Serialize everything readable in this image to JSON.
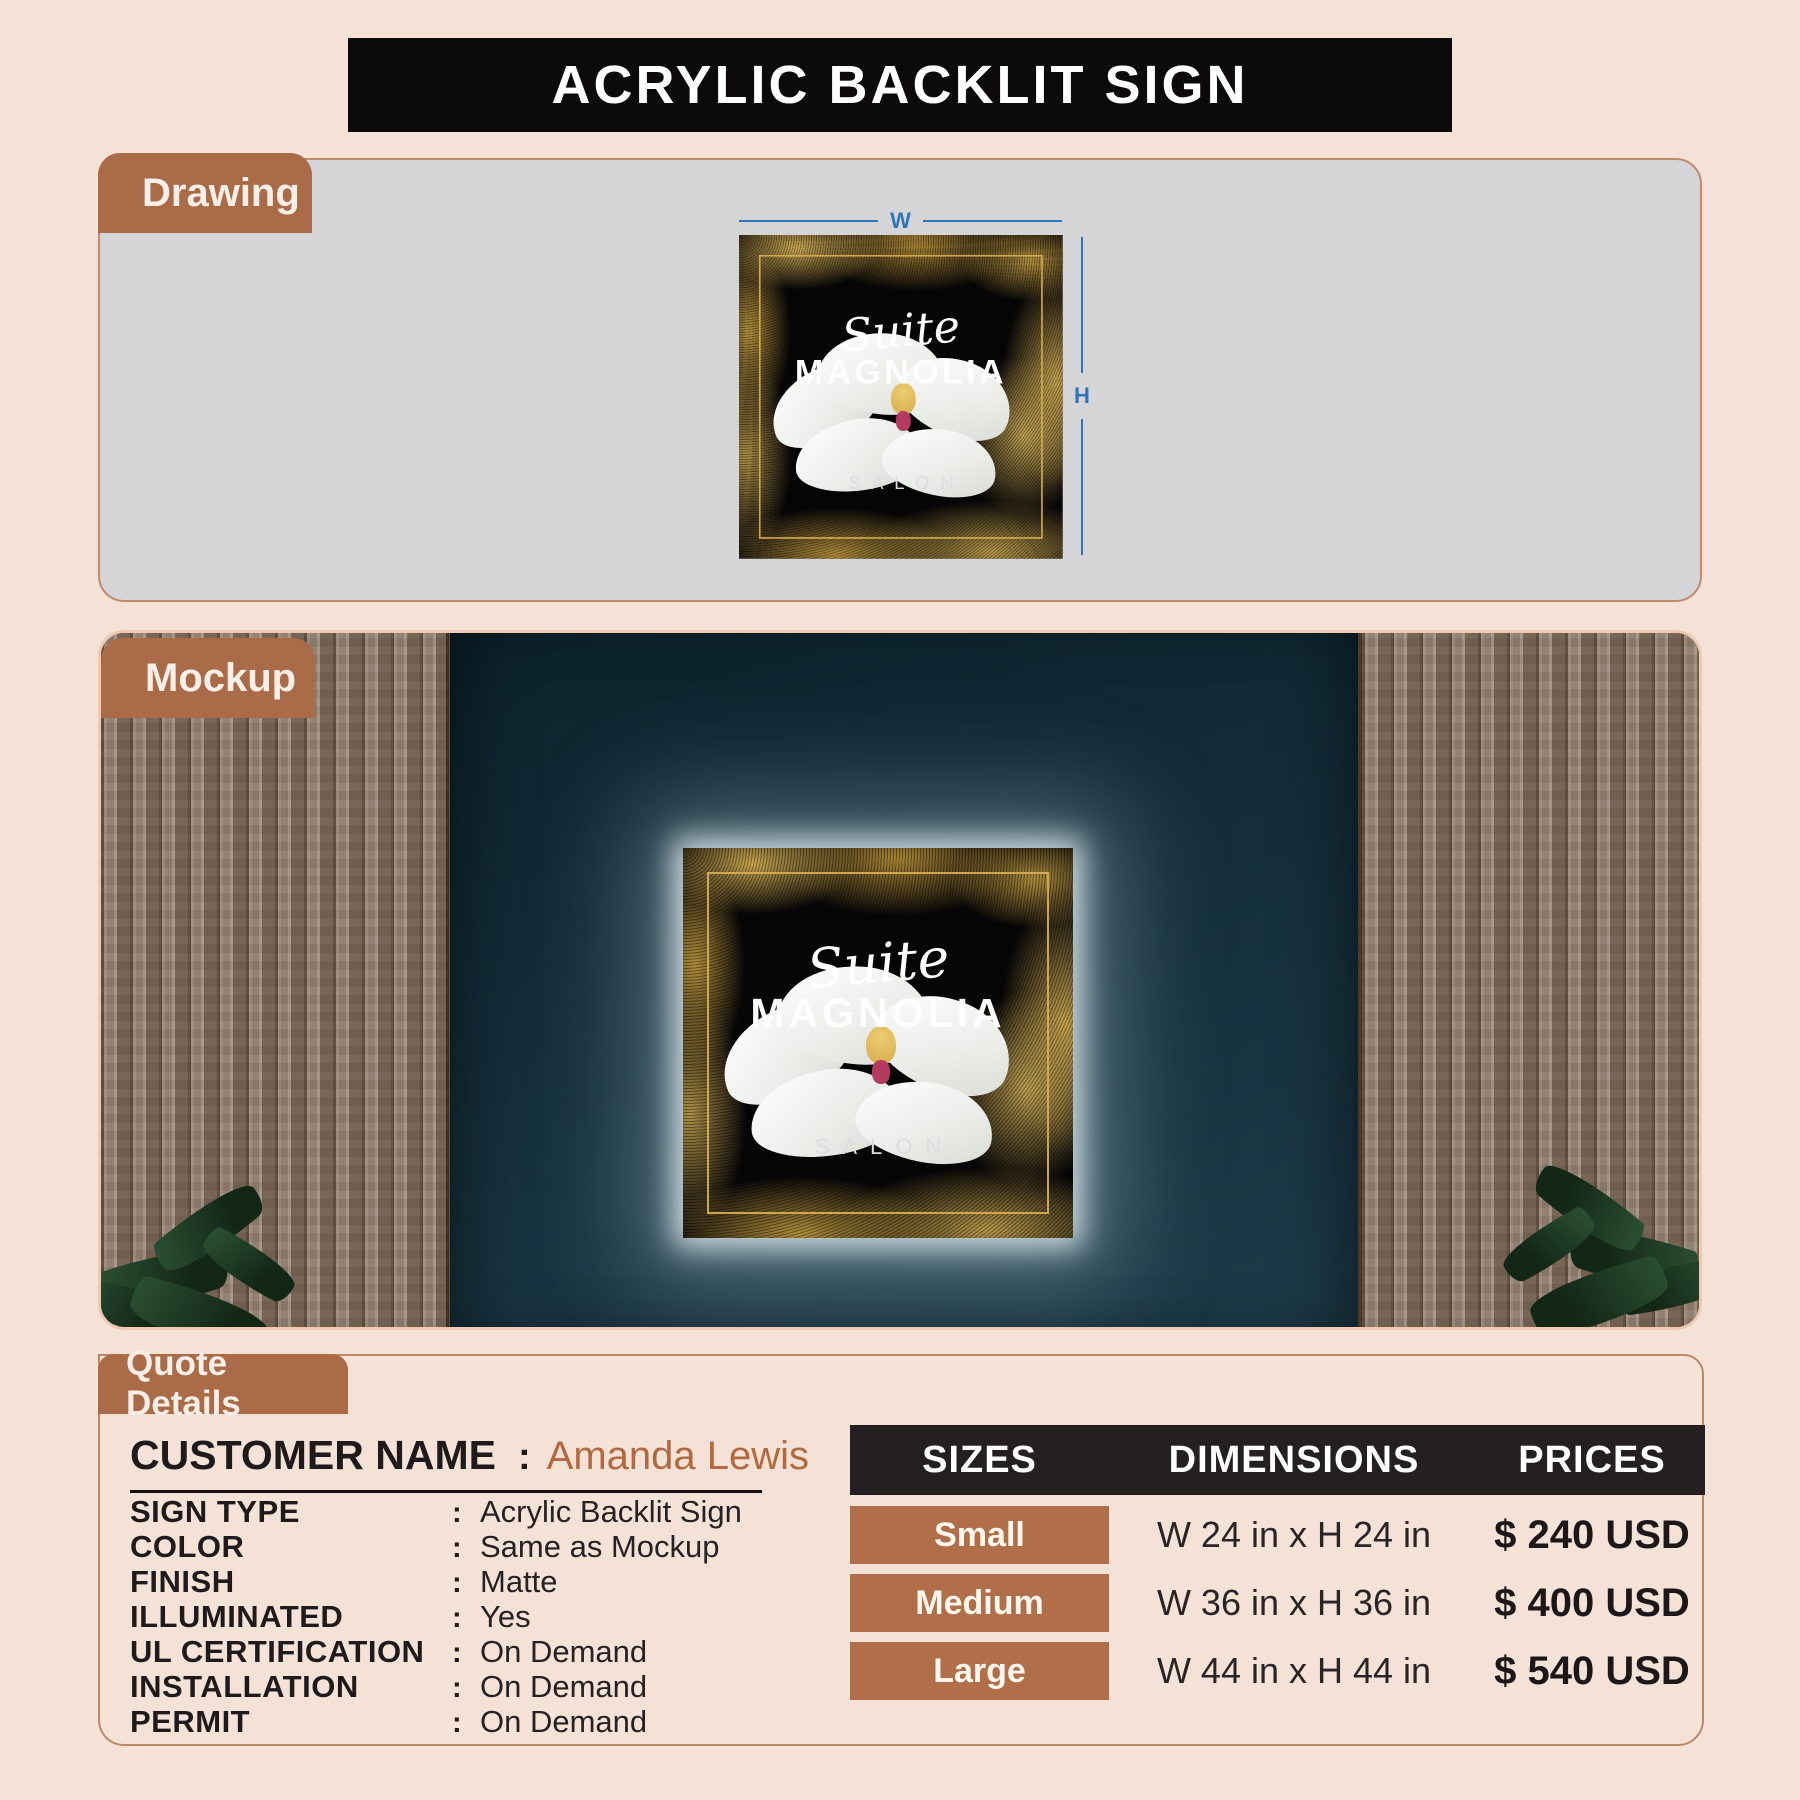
{
  "page": {
    "title": "ACRYLIC BACKLIT SIGN"
  },
  "sections": {
    "drawing": "Drawing",
    "mockup": "Mockup",
    "quote": "Quote Details"
  },
  "dimensions": {
    "width_label": "W",
    "height_label": "H"
  },
  "sign": {
    "brand_script": "Suite",
    "brand_name": "MAGNOLIA",
    "brand_tagline": "SALON"
  },
  "quote": {
    "separator": ":",
    "customer": {
      "label": "CUSTOMER NAME",
      "value": "Amanda Lewis"
    },
    "specs": [
      {
        "label": "SIGN TYPE",
        "value": "Acrylic Backlit Sign"
      },
      {
        "label": "COLOR",
        "value": "Same as Mockup"
      },
      {
        "label": "FINISH",
        "value": "Matte"
      },
      {
        "label": "ILLUMINATED",
        "value": "Yes"
      },
      {
        "label": "UL CERTIFICATION",
        "value": "On Demand"
      },
      {
        "label": "INSTALLATION",
        "value": "On Demand"
      },
      {
        "label": "PERMIT",
        "value": "On Demand"
      }
    ]
  },
  "pricing_table": {
    "headers": [
      "SIZES",
      "DIMENSIONS",
      "PRICES"
    ],
    "rows": [
      {
        "size": "Small",
        "dimensions": "W 24 in x H 24 in",
        "price": "$ 240 USD"
      },
      {
        "size": "Medium",
        "dimensions": "W 36 in x H 36 in",
        "price": "$ 400 USD"
      },
      {
        "size": "Large",
        "dimensions": "W 44 in x H 44 in",
        "price": "$ 540 USD"
      }
    ]
  },
  "colors": {
    "page_bg": "#f5e2d7",
    "header_bar": "#0d0a0b",
    "accent_brown": "#aa6b48",
    "badge_brown": "#b06f48",
    "table_header": "#242021",
    "panel_gray": "#d5d4d6",
    "wall_teal": "#16313f",
    "dimension_blue": "#2d76b9",
    "gold": "#c9a23e",
    "customer_name_brown": "#b2693f"
  }
}
